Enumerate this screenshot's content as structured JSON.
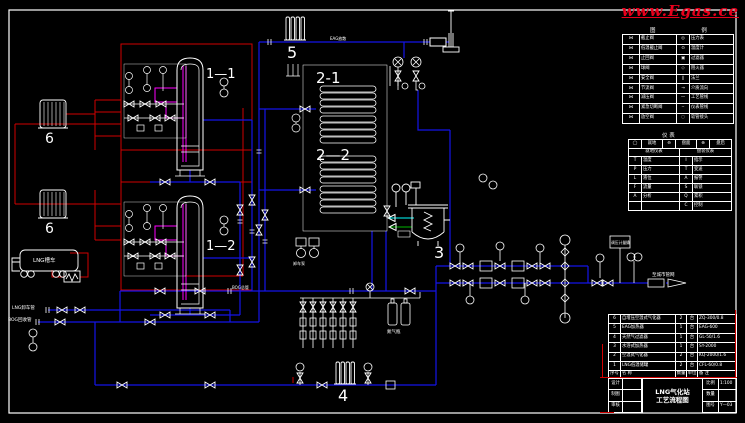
{
  "watermark": "www.Egas.ce",
  "labels": {
    "tank1": "1—1",
    "tank2": "1—2",
    "vaporizer1": "2-1",
    "vaporizer2": "2—2",
    "heater": "3",
    "filter": "4",
    "eag_heater": "5",
    "press_vap1": "6",
    "press_vap2": "6",
    "truck": "LNG槽车",
    "unload_line1": "LNG卸车管",
    "unload_line2": "BOG回收管",
    "bog_header": "BOG总管",
    "vent": "EAG放散",
    "n2_bottles": "氮气瓶",
    "outlet": "至城市管网",
    "pump": "卸车泵",
    "panel": "调压计量撬"
  },
  "legend": {
    "title": "图 例",
    "rows": [
      {
        "s1": "⋈",
        "n1": "截止阀",
        "s2": "◎",
        "n2": "压力表"
      },
      {
        "s1": "⋈",
        "n1": "低温截止阀",
        "s2": "⊙",
        "n2": "温度计"
      },
      {
        "s1": "⋈",
        "n1": "止回阀",
        "s2": "▣",
        "n2": "过滤器"
      },
      {
        "s1": "⋈",
        "n1": "球阀",
        "s2": "◇",
        "n2": "阻火器"
      },
      {
        "s1": "⋈",
        "n1": "安全阀",
        "s2": "∥",
        "n2": "法兰"
      },
      {
        "s1": "⋈",
        "n1": "节流阀",
        "s2": "→",
        "n2": "介质流向"
      },
      {
        "s1": "⋈",
        "n1": "减压阀",
        "s2": "—",
        "n2": "工艺管线"
      },
      {
        "s1": "⋈",
        "n1": "紧急切断阀",
        "s2": "╌",
        "n2": "仪表管线"
      },
      {
        "s1": "⋈",
        "n1": "放空阀",
        "s2": "◌",
        "n2": "软管接头"
      }
    ]
  },
  "inst": {
    "title": "仪 表",
    "symrow": [
      {
        "s1": "◯",
        "t1": "就地",
        "s2": "⊖",
        "t2": "盘面",
        "s3": "⊕",
        "t3": "盘后"
      }
    ],
    "head_left": "就地仪表",
    "head_right": "盘装仪表",
    "rows": [
      {
        "l1": "T",
        "n1": "温度",
        "l2": "I",
        "n2": "指示"
      },
      {
        "l1": "P",
        "n1": "压力",
        "l2": "T",
        "n2": "变送"
      },
      {
        "l1": "L",
        "n1": "液位",
        "l2": "A",
        "n2": "报警"
      },
      {
        "l1": "F",
        "n1": "流量",
        "l2": "S",
        "n2": "联锁"
      },
      {
        "l1": "A",
        "n1": "分析",
        "l2": "Q",
        "n2": "累积"
      },
      {
        "l1": "",
        "n1": "",
        "l2": "C",
        "n2": "控制"
      }
    ]
  },
  "parts": {
    "rows": [
      {
        "no": "6",
        "name": "自增压空温式气化器",
        "qty": "2",
        "unit": "台",
        "note": "ZQ-300/0.8"
      },
      {
        "no": "5",
        "name": "EAG加热器",
        "qty": "1",
        "unit": "台",
        "note": "EAG-600"
      },
      {
        "no": "4",
        "name": "天然气过滤器",
        "qty": "1",
        "unit": "台",
        "note": "GL-50/1.6"
      },
      {
        "no": "3",
        "name": "水浴式加热器",
        "qty": "1",
        "unit": "台",
        "note": "SY-2000"
      },
      {
        "no": "2",
        "name": "空温式气化器",
        "qty": "2",
        "unit": "台",
        "note": "KQ-2000/1.6"
      },
      {
        "no": "1",
        "name": "LNG低温储罐",
        "qty": "2",
        "unit": "台",
        "note": "CFL-60/0.8"
      }
    ],
    "header": [
      {
        "no": "序号",
        "name": "名  称",
        "qty": "数量",
        "unit": "单位",
        "note": "备  注"
      }
    ]
  },
  "titleblock": {
    "left_rows": [
      {
        "k": "设计",
        "v": ""
      },
      {
        "k": "制图",
        "v": ""
      },
      {
        "k": "审核",
        "v": ""
      }
    ],
    "title": "LNG气化站",
    "subtitle": "工艺流程图",
    "right_rows": [
      {
        "k": "比例",
        "v": "1:100"
      },
      {
        "k": "数量",
        "v": ""
      },
      {
        "k": "图号",
        "v": "Y—03"
      }
    ]
  }
}
